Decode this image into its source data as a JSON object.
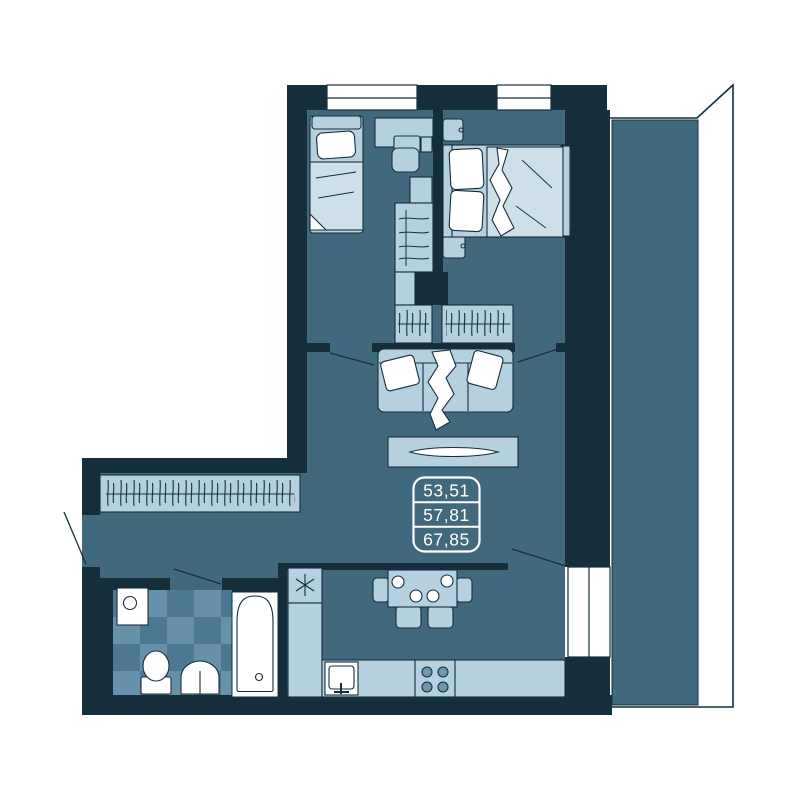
{
  "plan": {
    "area_box": {
      "values": [
        "53,51",
        "57,81",
        "67,85"
      ]
    },
    "colors": {
      "background": "#ffffff",
      "walls": "#152e3c",
      "floor": "#40697e",
      "furniture": "#b5d1e0",
      "furniture_soft": "#cde0ea",
      "tile_dark": "#4c7892",
      "tile_light": "#6791aa",
      "fixtures": "#ffffff",
      "text": "#ffffff"
    },
    "icons": {
      "fridge": "snowflake-asterisk-icon",
      "stove": "four-burners-icon",
      "wardrobes": "hanger-strokes-icon"
    }
  }
}
